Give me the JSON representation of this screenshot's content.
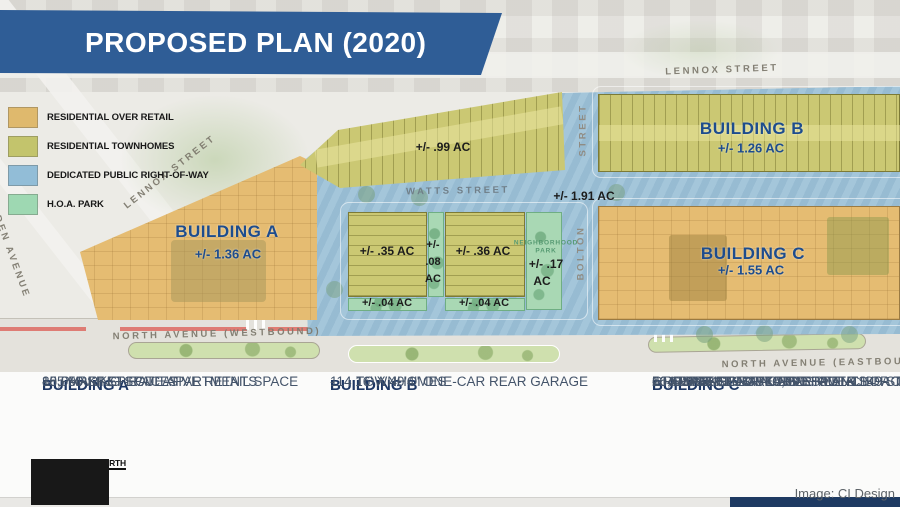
{
  "banner": {
    "title": "PROPOSED PLAN (2020)",
    "bg_color": "#2f5d96"
  },
  "legend": {
    "items": [
      {
        "label": "RESIDENTIAL OVER RETAIL",
        "color": "#dfb96d"
      },
      {
        "label": "RESIDENTIAL TOWNHOMES",
        "color": "#c3c46c"
      },
      {
        "label": "DEDICATED PUBLIC RIGHT-OF-WAY",
        "color": "#92bdd7"
      },
      {
        "label": "H.O.A. PARK",
        "color": "#9ed8b2"
      }
    ]
  },
  "map": {
    "labels": {
      "lennox_top": "LENNOX STREET",
      "lennox_diag": "LENNOX STREET",
      "linden": "LINDEN AVENUE",
      "watts": "WATTS STREET",
      "bolton_upper": "STREET",
      "bolton_lower": "BOLTON",
      "north_west": "NORTH AVENUE (WESTBOUND)",
      "north_east": "NORTH AVENUE (EASTBOUND",
      "row_area": "+/- 1.91 AC"
    },
    "parcels": {
      "building_a": {
        "name": "BUILDING A",
        "area": "+/- 1.36 AC"
      },
      "building_b": {
        "name": "BUILDING B",
        "area": "+/- 1.26 AC"
      },
      "building_c": {
        "name": "BUILDING C",
        "area": "+/- 1.55 AC"
      },
      "townhomes": {
        "area": "+/- .99 AC"
      },
      "p35": {
        "area": "+/- .35 AC"
      },
      "p36": {
        "area": "+/- .36 AC"
      },
      "p08": {
        "l1": "+/-",
        "l2": ".08",
        "l3": "AC"
      },
      "park": {
        "n1": "NEIGHBORHOOD",
        "n2": "PARK",
        "a1": "+/- .17",
        "a2": "AC"
      },
      "p04a": {
        "area": "+/- .04 AC"
      },
      "p04b": {
        "area": "+/- .04 AC"
      }
    }
  },
  "details": {
    "dash": "-",
    "columns": [
      {
        "title": "BUILDING A",
        "items": [
          [
            "155 MARKET-RATE APARTMENTS"
          ],
          [
            "10,050 SF SPECULATIVE RETAIL SPACE"
          ],
          [
            "88 PARKING SPACES"
          ]
        ]
      },
      {
        "title": "BUILDING B",
        "items": [
          [
            "114 16' X 40'4\" ONE-CAR REAR GARAGE",
            "TOWNHOMES"
          ]
        ]
      },
      {
        "title": "BUILDING C",
        "items": [
          [
            "264 MARKET-RATE APARTMENTS"
          ],
          [
            "5 RESIDENTIAL STORIES OVER 149 STR",
            "PARKING SPACES"
          ],
          [
            "GROUND FLOOR 15,000 SF ANCHOR T"
          ],
          [
            "16,400 SF SPECULATIVE RETIAL SPACE"
          ],
          [
            "50 SURFACE PARKING SPACES"
          ]
        ]
      }
    ]
  },
  "logo": {
    "title": "MADISON PARK NORTH",
    "palette": [
      "#4f7db3",
      "#6fa14c",
      "#e9e5d2",
      "#3f6da6",
      "#7fb35a",
      "#d9d4be",
      "#2b5e9e",
      "#161616",
      "#87a855",
      "#e1ddc6"
    ]
  },
  "credit": "Image: CI Design",
  "colors": {
    "residential_over_retail": "#e5bc72",
    "residential_townhomes": "#cbc873",
    "public_right_of_way": "#9ec2d8",
    "hoa_park": "#a9d8b4",
    "building_label": "#1d4c8d",
    "banner_blue": "#2f5d96",
    "footer_text": "#44546a",
    "footer_header": "#1f3864",
    "north_ave_red": "#dd6a62",
    "navy_bar": "#1e3a62"
  }
}
